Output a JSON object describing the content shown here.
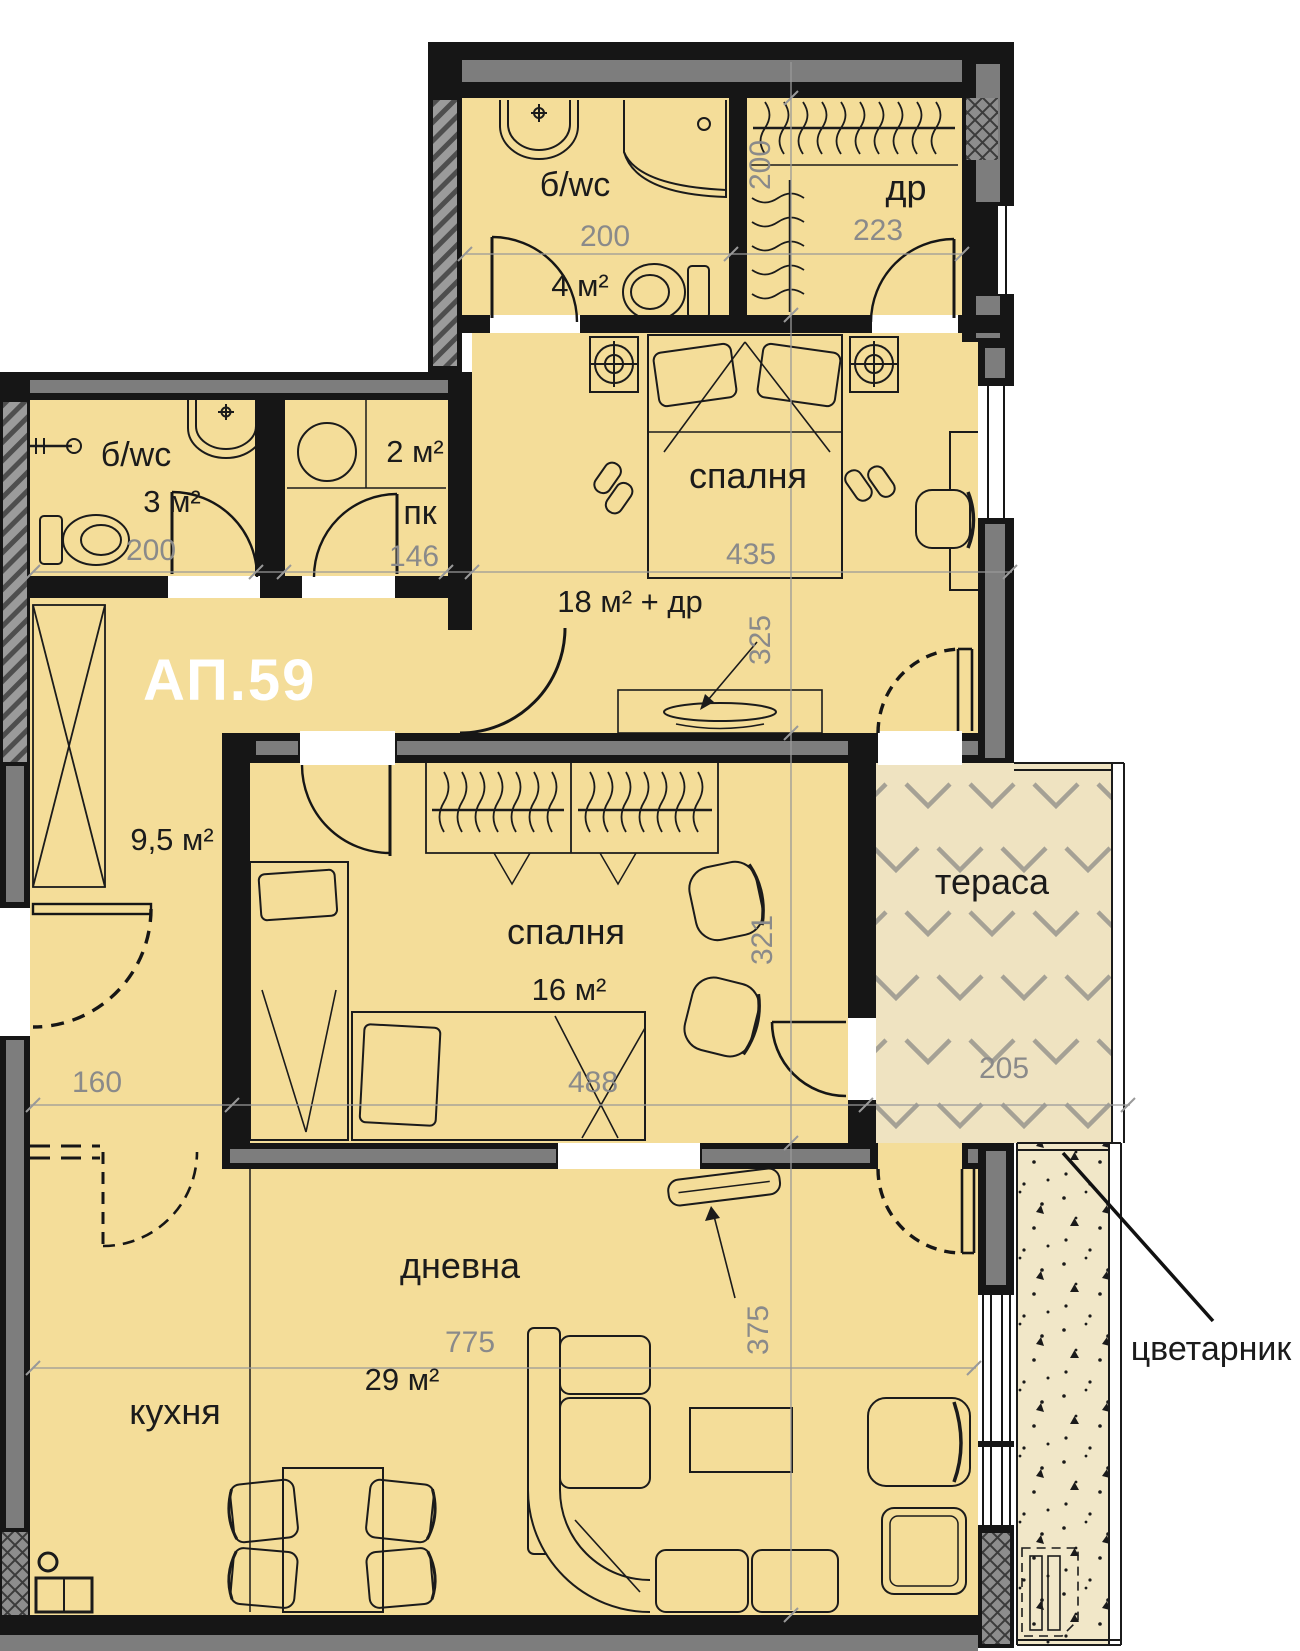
{
  "plan": {
    "apartment_label": "АП.59",
    "rooms": {
      "bath_top": {
        "label": "б/wc",
        "area": "4 м²"
      },
      "closet": {
        "label": "др"
      },
      "bedroom_main": {
        "label": "спалня",
        "area": "18 м² + др"
      },
      "bath_hall": {
        "label": "б/wc",
        "area": "3 м²"
      },
      "pantry": {
        "label": "пк",
        "area": "2 м²"
      },
      "hall": {
        "area": "9,5 м²"
      },
      "bedroom_second": {
        "label": "спалня",
        "area": "16 м²"
      },
      "terrace": {
        "label": "тераса"
      },
      "living": {
        "label": "дневна"
      },
      "kitchen": {
        "label": "кухня"
      },
      "living_kitchen_area": "29 м²",
      "planter": {
        "label": "цветарник"
      }
    },
    "dimensions": {
      "bath_top_width": "200",
      "closet_width": "223",
      "closet_depth": "200",
      "bedroom_main_width": "435",
      "bedroom_main_depth": "325",
      "bath_hall_width": "200",
      "pantry_width": "146",
      "hall_width": "160",
      "bedroom_second_width": "488",
      "bedroom_second_depth": "321",
      "terrace_width": "205",
      "living_width": "775",
      "living_depth": "375"
    }
  }
}
